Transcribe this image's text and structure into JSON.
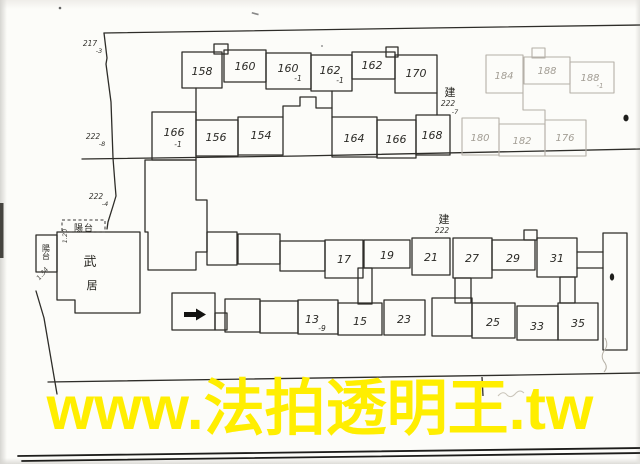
{
  "watermark": {
    "text": "www.法拍透明王.tw",
    "color": "#ffee00"
  },
  "plan": {
    "upper_building": {
      "building_label": {
        "char": "建",
        "number": "222",
        "suffix": "-7"
      },
      "units_top": [
        {
          "main": "158",
          "sub": ""
        },
        {
          "main": "160",
          "sub": ""
        },
        {
          "main": "160",
          "sub": "-1"
        },
        {
          "main": "162",
          "sub": "-1"
        },
        {
          "main": "162",
          "sub": ""
        },
        {
          "main": "170",
          "sub": ""
        }
      ],
      "units_bottom": [
        {
          "main": "166",
          "sub": "-1"
        },
        {
          "main": "156",
          "sub": ""
        },
        {
          "main": "154",
          "sub": ""
        },
        {
          "main": "164",
          "sub": ""
        },
        {
          "main": "166",
          "sub": ""
        },
        {
          "main": "168",
          "sub": ""
        }
      ],
      "units_top_faint": [
        {
          "main": "184",
          "sub": ""
        },
        {
          "main": "188",
          "sub": ""
        },
        {
          "main": "188",
          "sub": "-1"
        }
      ],
      "units_bottom_faint": [
        {
          "main": "180",
          "sub": ""
        },
        {
          "main": "182",
          "sub": ""
        },
        {
          "main": "176",
          "sub": ""
        }
      ]
    },
    "lower_building": {
      "building_label": {
        "char": "建",
        "number": "222"
      },
      "units_top": [
        "17",
        "19",
        "21",
        "27",
        "29",
        "31"
      ],
      "units_bottom": [
        {
          "main": "13",
          "sub": "-9"
        },
        {
          "main": "15",
          "sub": ""
        },
        {
          "main": "23",
          "sub": ""
        },
        {
          "main": "25",
          "sub": ""
        },
        {
          "main": "33",
          "sub": ""
        },
        {
          "main": "35",
          "sub": ""
        }
      ]
    },
    "house": {
      "label_char_1": "武",
      "label_char_2": "居",
      "balcony_top_label": "陽台",
      "balcony_left_label": "陽台",
      "dim_top": "1.20",
      "dim_left": "1.34"
    },
    "boundary_markers": [
      {
        "main": "217",
        "sub": "-3"
      },
      {
        "main": "222",
        "sub": "-8"
      },
      {
        "main": "222",
        "sub": "-4"
      }
    ]
  }
}
